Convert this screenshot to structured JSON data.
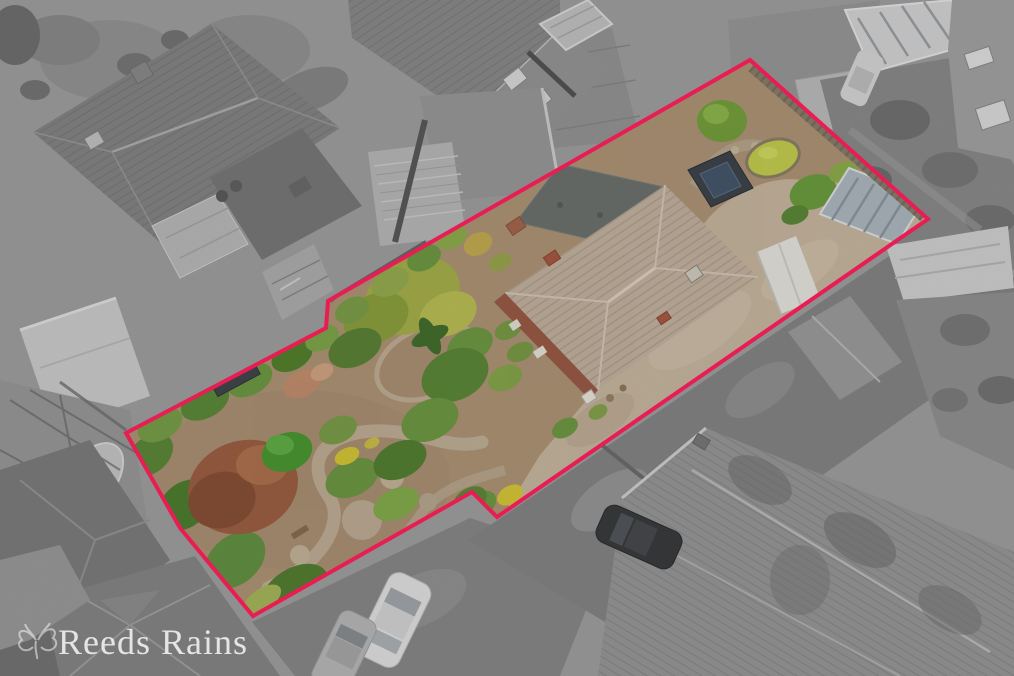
{
  "image": {
    "width": 1014,
    "height": 676,
    "kind": "aerial-drone-photograph",
    "description": "Overhead estate-agent drone photo of a detached bungalow and its long rear garden. The property plot is shown in colour and outlined in red; all neighbouring houses, roads and gardens are desaturated greyscale."
  },
  "boundary": {
    "color": "#e81d53",
    "stroke_width": 4,
    "points_attr": "750,60 928,219 497,517 472,492 253,616 180,528 126,433 326,328 328,301"
  },
  "branding": {
    "watermark_text": "Reeds Rains",
    "watermark_color": "#ffffff",
    "watermark_icon": "butterfly"
  },
  "palette": {
    "surroundings_gray": "#a6a6a6",
    "plot_soil": "#b19678",
    "plot_gravel_drive": "#cab9a2",
    "house_roof_tan": "#c5b4a2",
    "flat_roof_gray_green": "#6e7370",
    "brick_red": "#9d5c48",
    "garden_green_dark": "#4f7f31",
    "garden_green_light": "#9ab04e",
    "autumn_tree": "#9f6144",
    "pond_green": "#c6cf50",
    "shed_roof_dark": "#3f454c",
    "solar_panel_blue": "#47596d",
    "conservatory_glass": "#b1bac2",
    "white_garage": "#e9e7e1"
  },
  "features": {
    "inside_plot": [
      "main-house-hipped-roof",
      "rear-flat-roof",
      "gravel-driveway",
      "mature-garden",
      "autumn-tree",
      "garden-shed",
      "solar-panel-shed",
      "pond",
      "glass-conservatory",
      "white-garage",
      "boundary-fences"
    ],
    "outside_plot": [
      "neighbour-houses",
      "parked-cars",
      "shared-driveway",
      "conservatories",
      "lawns"
    ]
  }
}
